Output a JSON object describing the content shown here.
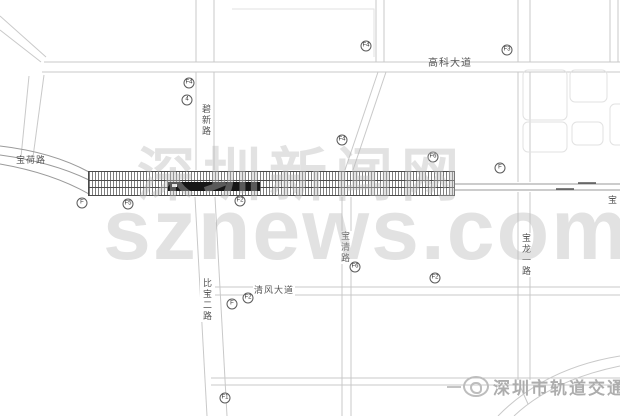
{
  "map": {
    "road_labels": [
      {
        "id": "baohe-road",
        "text": "宝荷路"
      },
      {
        "id": "bixin-road",
        "text": "碧新路"
      },
      {
        "id": "gaoke-avenue",
        "text": "高科大道"
      },
      {
        "id": "bibao-2nd-road",
        "text": "比宝二路"
      },
      {
        "id": "qingfeng-avenue",
        "text": "清风大道"
      },
      {
        "id": "baoqing-road",
        "text": "宝清路"
      },
      {
        "id": "baolong-1st-road",
        "text": "宝龙一路"
      },
      {
        "id": "bao-edge",
        "text": "宝"
      }
    ],
    "markers": [
      {
        "label": "F"
      },
      {
        "label": "F5"
      },
      {
        "label": "F2"
      },
      {
        "label": "F6"
      },
      {
        "label": "F"
      },
      {
        "label": "F4"
      },
      {
        "label": "4"
      },
      {
        "label": "F4"
      },
      {
        "label": "F3"
      },
      {
        "label": "F4"
      },
      {
        "label": "F"
      },
      {
        "label": "F2"
      },
      {
        "label": "F6"
      },
      {
        "label": "F2"
      },
      {
        "label": "F1"
      }
    ],
    "colors": {
      "road_line": "#c9c9c9",
      "rail_line": "#9a9a9a",
      "station_ink": "#4a4a4a",
      "station_fill": "#161616",
      "watermark": "#bababa",
      "credit": "#adadad"
    }
  },
  "watermarks": {
    "site_cn": "深圳新闻网",
    "site_en": "sznews.com",
    "credit": "深圳市轨道交通"
  }
}
